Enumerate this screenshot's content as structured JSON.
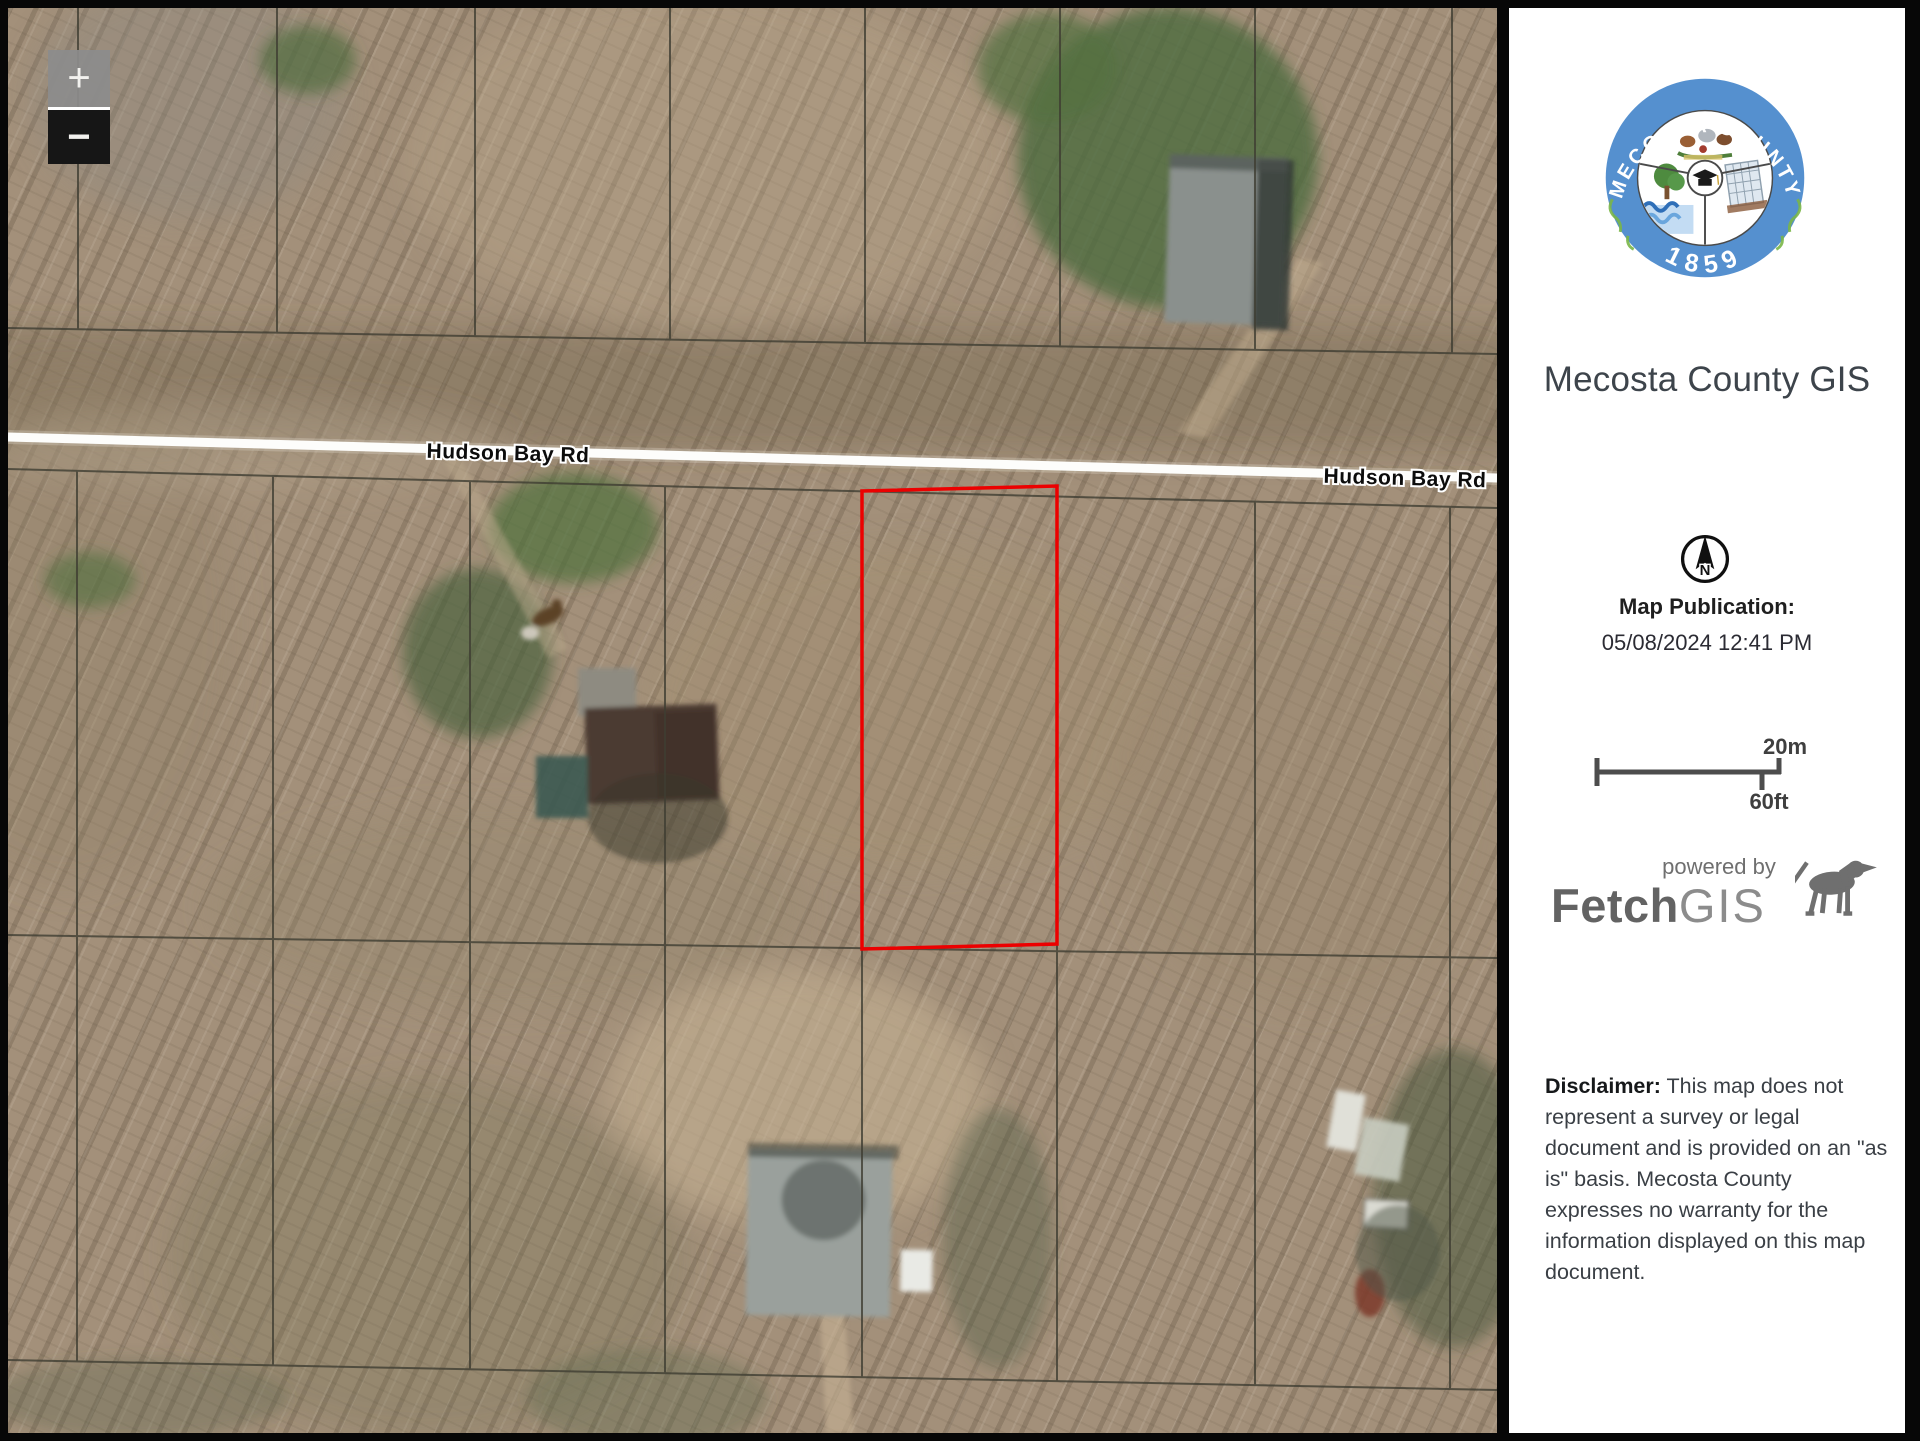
{
  "map": {
    "zoom_in_label": "+",
    "zoom_out_label": "−",
    "road_label_1": "Hudson Bay Rd",
    "road_label_2": "Hudson Bay Rd"
  },
  "sidebar": {
    "logo": {
      "arc_text": "MECOSTA COUNTY",
      "year": "1859"
    },
    "title": "Mecosta County GIS",
    "north_label": "N",
    "publication_label": "Map Publication:",
    "publication_datetime": "05/08/2024 12:41 PM",
    "scale": {
      "metric": "20m",
      "imperial": "60ft"
    },
    "powered_by": "powered by",
    "brand_bold": "Fetch",
    "brand_light": "GIS",
    "disclaimer_label": "Disclaimer:",
    "disclaimer_text": " This map does not represent a survey or legal document and is provided on an \"as is\" basis. Mecosta County expresses no warranty for the information displayed on this map document."
  },
  "colors": {
    "parcel_highlight_red": "#ec0000",
    "seal_blue": "#5590cf",
    "road_white": "#fdfdfb",
    "parcel_line": "#3f3e33"
  }
}
